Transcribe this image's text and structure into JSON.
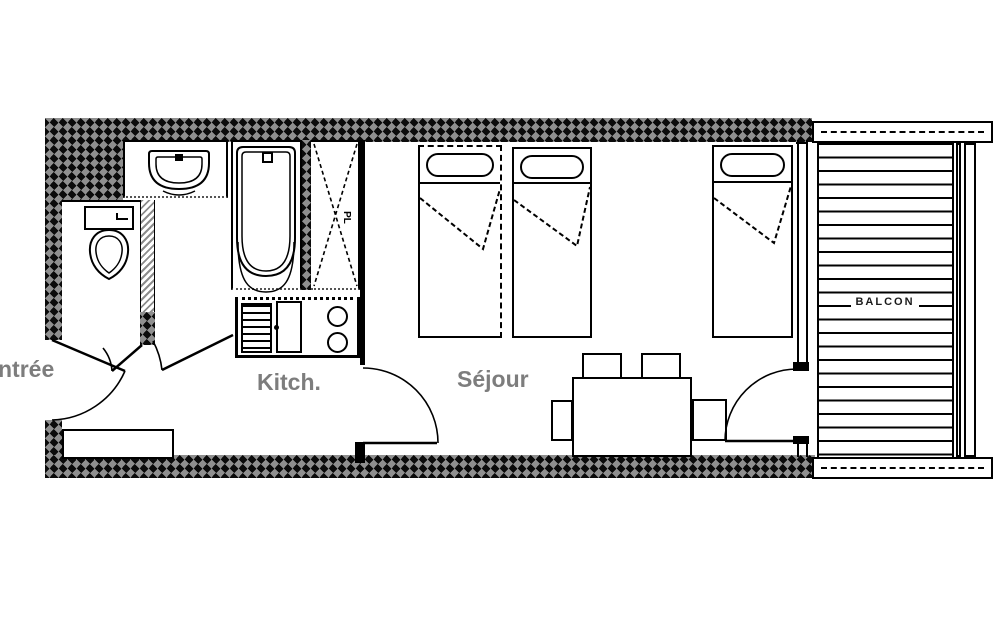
{
  "labels": {
    "entrance": "ntrée",
    "kitchen": "Kitch.",
    "living_room": "Séjour",
    "balcony": "BALCON",
    "closet": "PL"
  },
  "colors": {
    "line": "#000000",
    "room_label_gray": "#7d7d7d",
    "wall_pattern_dark": "#0b0b0b",
    "wall_pattern_gray": "#8f8f8f",
    "background": "#ffffff"
  },
  "fixtures": [
    "washbasin",
    "bathtub",
    "wall-closet",
    "toilet",
    "kitchen-drainboard",
    "kitchen-sink",
    "stove-burners",
    "single-bed",
    "single-bed",
    "single-bed",
    "dining-table",
    "chair",
    "chair",
    "chair",
    "chair",
    "entry-bench",
    "balcony-decking"
  ]
}
